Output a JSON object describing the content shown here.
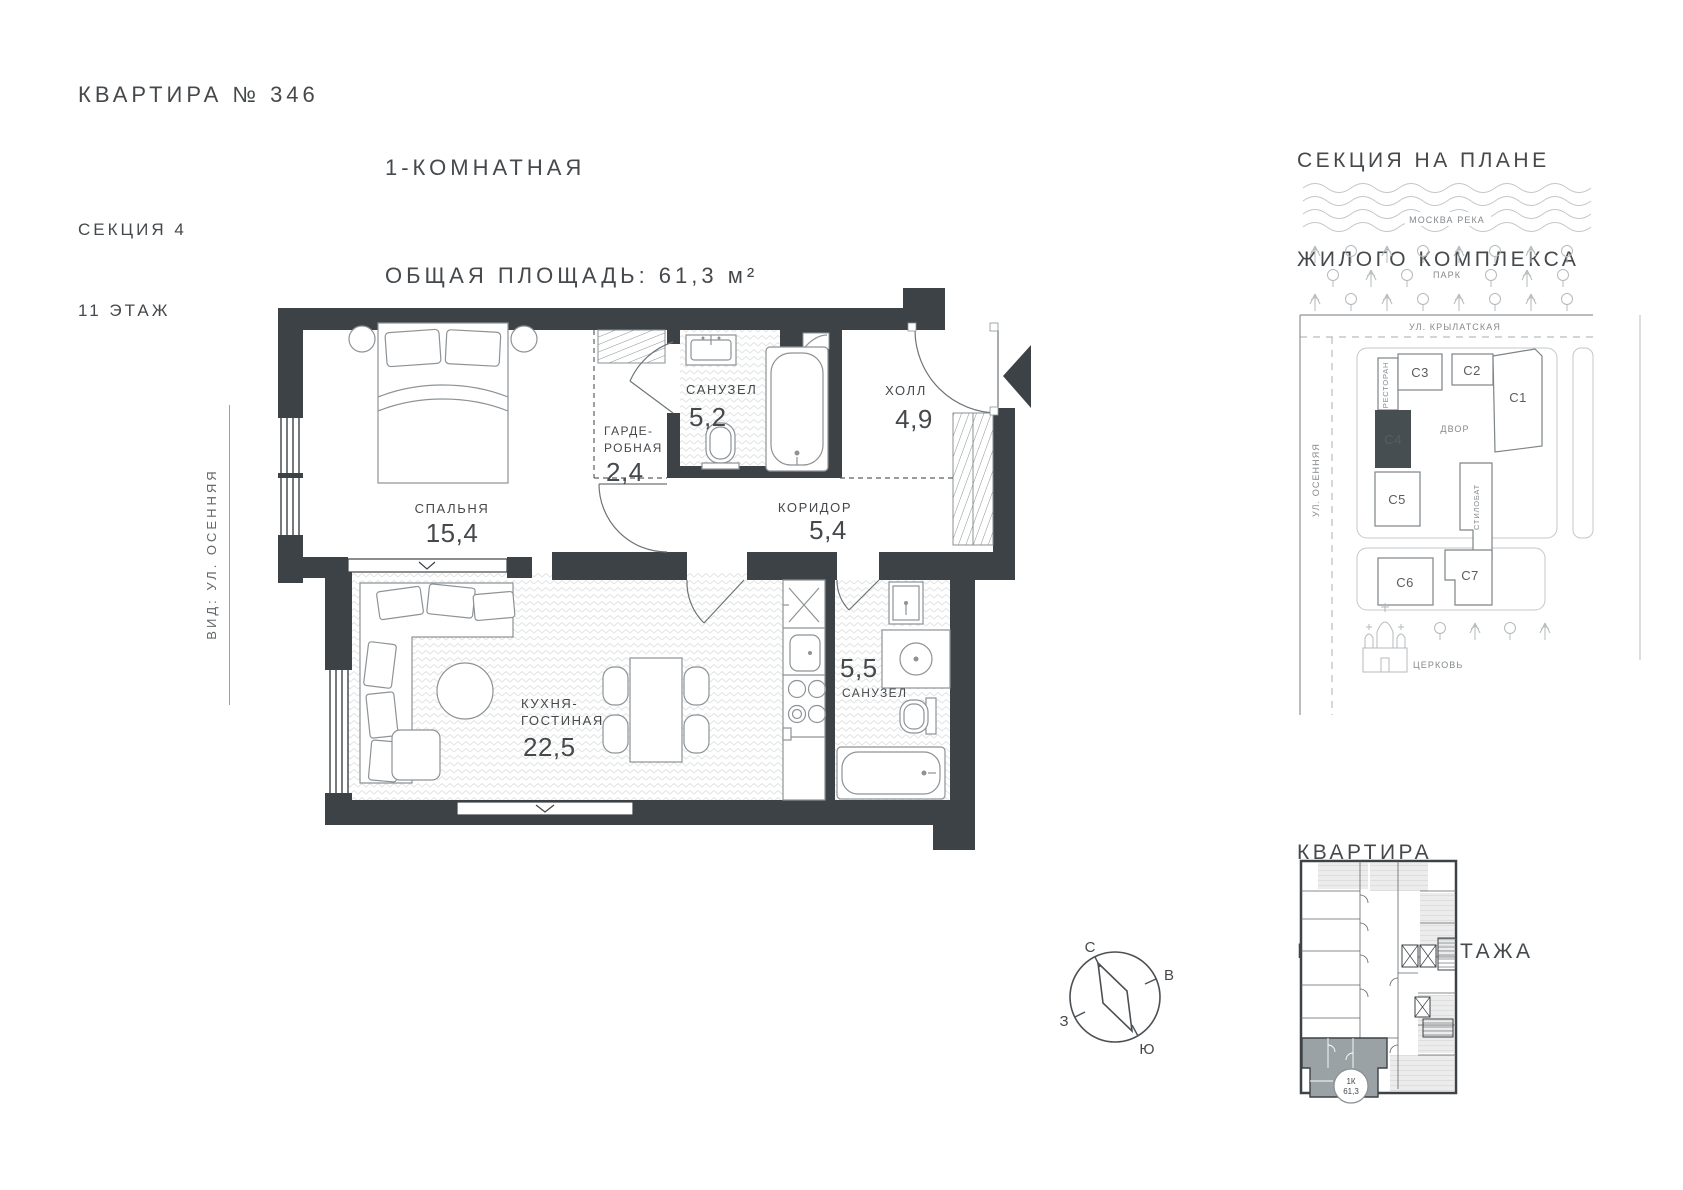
{
  "header": {
    "apartment": "КВАРТИРА № 346",
    "section": "СЕКЦИЯ 4",
    "floor": "11 ЭТАЖ",
    "rooms_type": "1-КОМНАТНАЯ",
    "total_area": "ОБЩАЯ ПЛОЩАДЬ: 61,3 м²"
  },
  "view_label": "ВИД: УЛ. ОСЕННЯЯ",
  "plan": {
    "bedroom": {
      "name": "СПАЛЬНЯ",
      "area": "15,4"
    },
    "wardrobe": {
      "name_line1": "ГАРДЕ-",
      "name_line2": "РОБНАЯ",
      "area": "2,4"
    },
    "bathroom_top": {
      "name": "САНУЗЕЛ",
      "area": "5,2"
    },
    "hall": {
      "name": "ХОЛЛ",
      "area": "4,9"
    },
    "corridor": {
      "name": "КОРИДОР",
      "area": "5,4"
    },
    "kitchen_living": {
      "name_line1": "КУХНЯ-",
      "name_line2": "ГОСТИНАЯ",
      "area": "22,5"
    },
    "bathroom_bottom": {
      "name": "САНУЗЕЛ",
      "area": "5,5"
    }
  },
  "compass": {
    "north": "С",
    "east": "В",
    "south": "Ю",
    "west": "З"
  },
  "site_plan": {
    "title_line1": "СЕКЦИЯ НА ПЛАНЕ",
    "title_line2": "ЖИЛОГО КОМПЛЕКСА",
    "river": "МОСКВА РЕКА",
    "park": "ПАРК",
    "street_top": "УЛ. КРЫЛАТСКАЯ",
    "street_left": "УЛ. ОСЕННЯЯ",
    "restaurant": "РЕСТОРАН",
    "courtyard": "ДВОР",
    "stylobate": "СТИЛОБАТ",
    "church": "ЦЕРКОВЬ",
    "sections": {
      "c1": "С1",
      "c2": "С2",
      "c3": "С3",
      "c4": "С4",
      "c5": "С5",
      "c6": "С6",
      "c7": "С7"
    }
  },
  "floor_overview": {
    "title_line1": "КВАРТИРА",
    "title_line2": "НА ПЛАНЕ ЭТАЖА",
    "badge_line1": "1К",
    "badge_line2": "61,3"
  },
  "colors": {
    "wall": "#3c4245",
    "text": "#45494c",
    "section_highlight": "#474e52",
    "unit_highlight": "#9ba2a6"
  }
}
